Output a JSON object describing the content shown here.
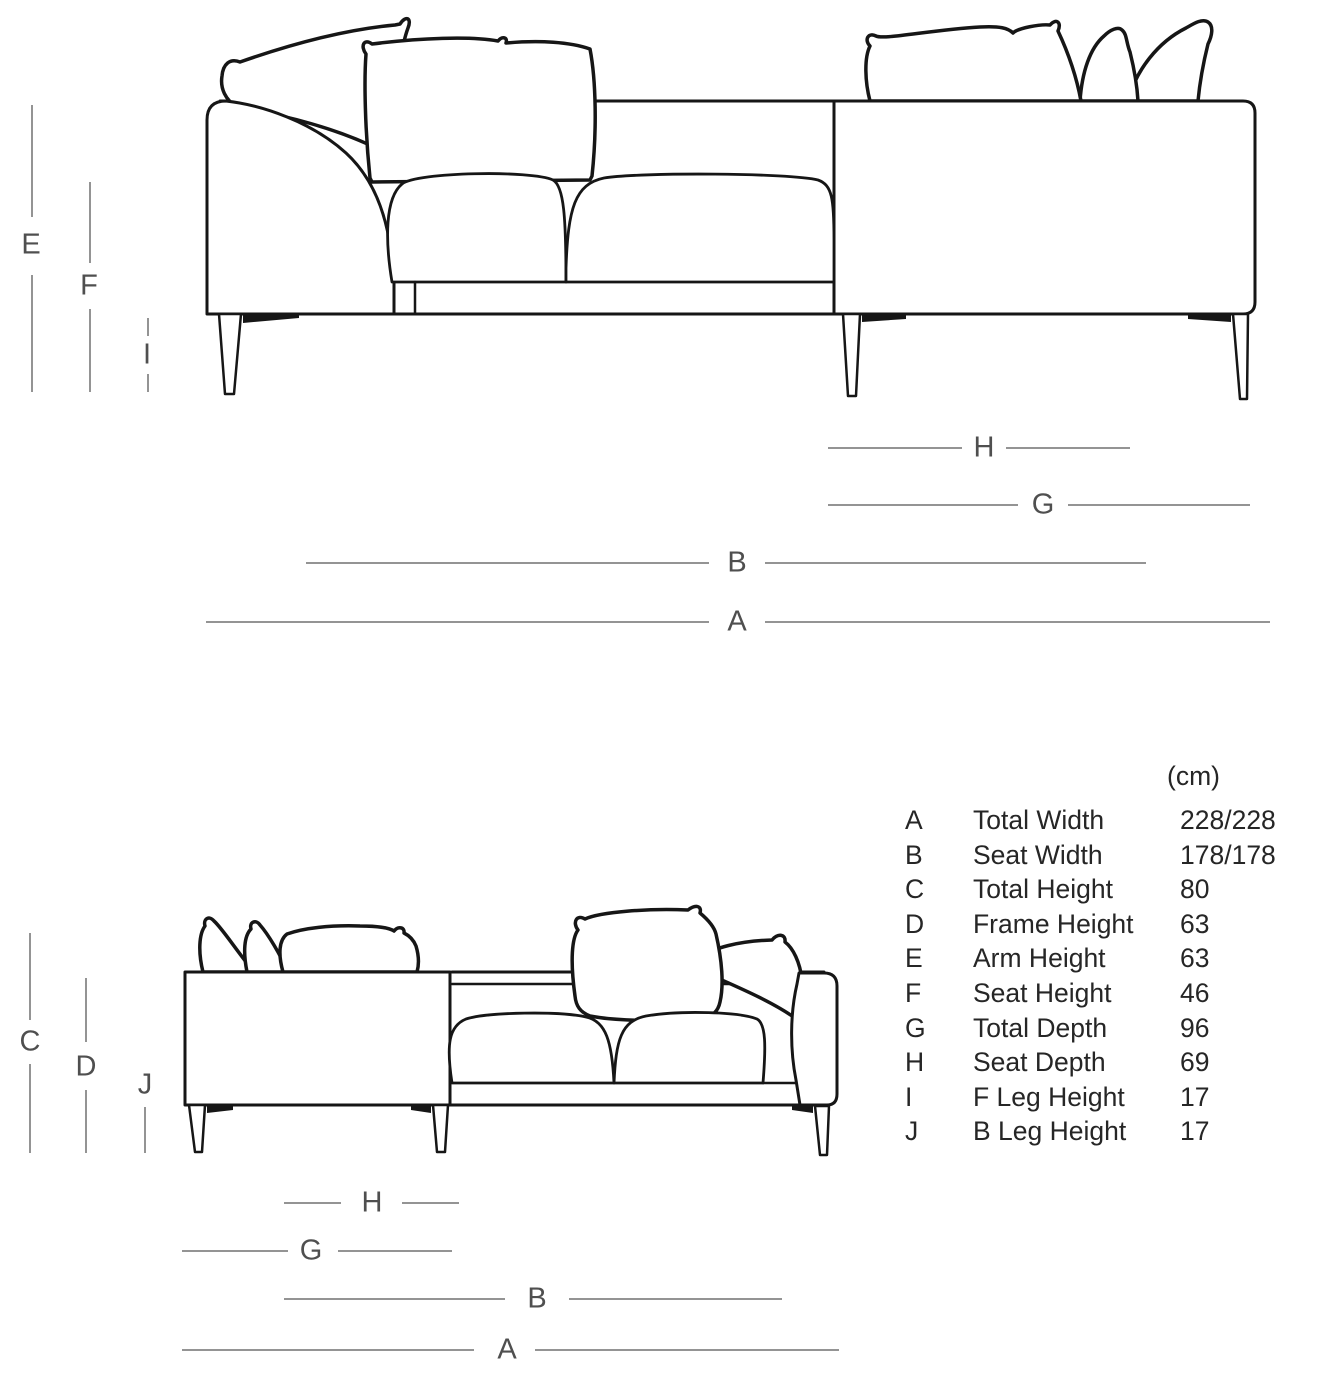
{
  "unit_label": "(cm)",
  "labels": {
    "top": [
      "E",
      "F",
      "I",
      "H",
      "G",
      "B",
      "A"
    ],
    "bottom": [
      "C",
      "D",
      "J",
      "H",
      "G",
      "B",
      "A"
    ]
  },
  "size_table": {
    "rows": [
      {
        "key": "A",
        "label": "Total Width",
        "value": "228/228"
      },
      {
        "key": "B",
        "label": "Seat Width",
        "value": "178/178"
      },
      {
        "key": "C",
        "label": "Total Height",
        "value": "80"
      },
      {
        "key": "D",
        "label": "Frame Height",
        "value": "63"
      },
      {
        "key": "E",
        "label": "Arm Height",
        "value": "63"
      },
      {
        "key": "F",
        "label": "Seat Height",
        "value": "46"
      },
      {
        "key": "G",
        "label": "Total Depth",
        "value": "96"
      },
      {
        "key": "H",
        "label": "Seat Depth",
        "value": "69"
      },
      {
        "key": "I",
        "label": "F Leg Height",
        "value": "17"
      },
      {
        "key": "J",
        "label": "B Leg Height",
        "value": "17"
      }
    ]
  },
  "colors": {
    "line": "#161616",
    "dimension_line": "#949494",
    "dimension_label": "#4f4f4f",
    "table_text": "#262626"
  }
}
